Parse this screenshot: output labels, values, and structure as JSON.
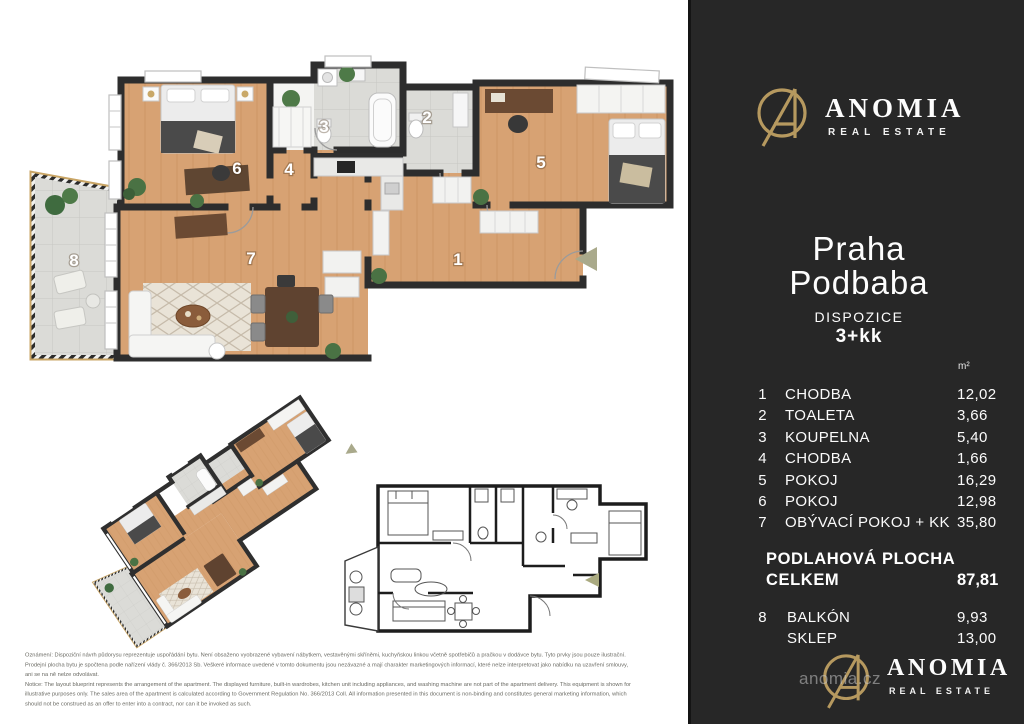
{
  "brand": {
    "name": "ANOMIA",
    "tagline": "REAL ESTATE",
    "website_watermark": "anomia.cz"
  },
  "panel": {
    "city": "Praha",
    "district": "Podbaba",
    "layout_label": "DISPOZICE",
    "layout_value": "3+kk",
    "area_unit": "m²",
    "rooms": [
      {
        "num": "1",
        "name": "CHODBA",
        "area": "12,02"
      },
      {
        "num": "2",
        "name": "TOALETA",
        "area": "3,66"
      },
      {
        "num": "3",
        "name": "KOUPELNA",
        "area": "5,40"
      },
      {
        "num": "4",
        "name": "CHODBA",
        "area": "1,66"
      },
      {
        "num": "5",
        "name": "POKOJ",
        "area": "16,29"
      },
      {
        "num": "6",
        "name": "POKOJ",
        "area": "12,98"
      },
      {
        "num": "7",
        "name": "OBÝVACÍ POKOJ + KK",
        "area": "35,80"
      }
    ],
    "total": {
      "label_line1": "PODLAHOVÁ PLOCHA",
      "label_line2": "CELKEM",
      "value": "87,81"
    },
    "extras": [
      {
        "num": "8",
        "name": "BALKÓN",
        "area": "9,93"
      },
      {
        "num": "",
        "name": "SKLEP",
        "area": "13,00"
      }
    ],
    "colors": {
      "background": "#272727",
      "gold": "#b6995f",
      "text": "#ffffff"
    }
  },
  "floorplan": {
    "labels": {
      "r1": "1",
      "r2": "2",
      "r3": "3",
      "r4": "4",
      "r5": "5",
      "r6": "6",
      "r7": "7",
      "r8": "8"
    }
  },
  "disclaimer": {
    "lines": [
      "Oznámení: Dispoziční návrh půdorysu reprezentuje uspořádání bytu. Není obsaženo vyobrazené vybavení nábytkem, vestavěnými skříněmi, kuchyňskou linkou včetně spotřebičů a pračkou v dodávce bytu. Tyto prvky jsou pouze ilustrační.",
      "Prodejní plocha bytu je spočtena podle nařízení vlády č. 366/2013 Sb. Veškeré informace uvedené v tomto dokumentu jsou nezávazné a mají charakter marketingových informací, které nelze interpretovat jako nabídku na uzavření smlouvy,",
      "ani se na ně nelze odvolávat.",
      "Notice: The layout blueprint represents the arrangement of the apartment. The displayed furniture, built-in wardrobes, kitchen unit including appliances, and washing machine are not part of the apartment delivery. This equipment is shown for",
      "illustrative purposes only. The sales area of the apartment is calculated according to Government Regulation No. 366/2013 Coll. All information presented in this document is non-binding and constitutes general marketing information, which",
      "should not be construed as an offer to enter into a contract, nor can it be invoked as such."
    ]
  }
}
